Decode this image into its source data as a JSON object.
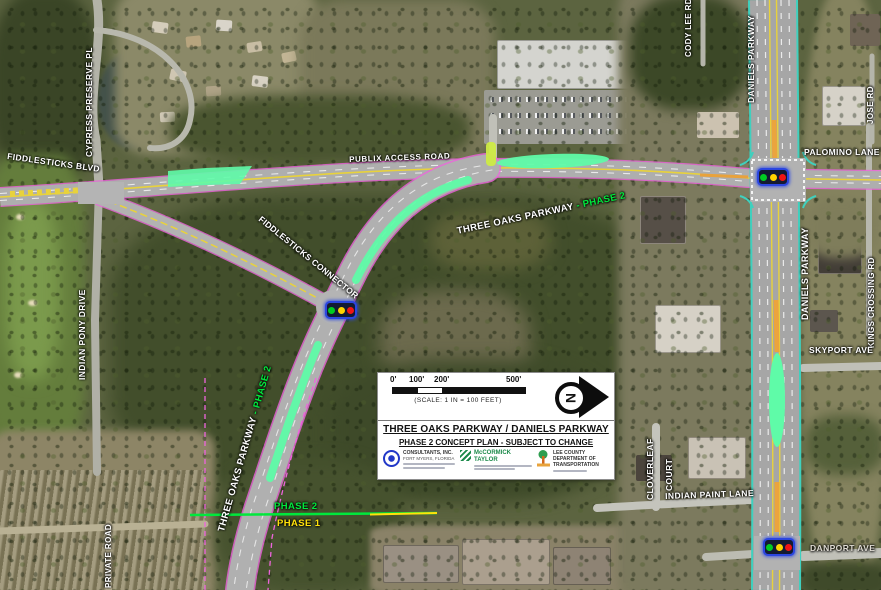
{
  "colors": {
    "phase2_green": "#00e83c",
    "phase1_yellow": "#ffe10a",
    "highlight_green": "#5ffba8",
    "row_magenta": "#ee64dd",
    "lane_yellow": "#e8d23c",
    "edge_teal": "#3fd0be",
    "signal_green": "#00cc22",
    "signal_yellow": "#ffd400",
    "signal_red": "#f01414"
  },
  "map": {
    "labels": [
      {
        "id": "fiddlesticks-blvd",
        "text": "FIDDLESTICKS BLVD"
      },
      {
        "id": "cypress-preserve-pl",
        "text": "CYPRESS PRESERVE PL"
      },
      {
        "id": "publix-access-road",
        "text": "PUBLIX ACCESS ROAD"
      },
      {
        "id": "three-oaks-parkway-curve",
        "text": "THREE OAKS PARKWAY"
      },
      {
        "id": "three-oaks-phase2-curve",
        "text": "- PHASE 2"
      },
      {
        "id": "fiddlesticks-connector",
        "text": "FIDDLESTICKS CONNECTOR"
      },
      {
        "id": "cody-lee-rd",
        "text": "CODY LEE RD"
      },
      {
        "id": "daniels-parkway-north",
        "text": "DANIELS PARKWAY"
      },
      {
        "id": "jose-rd",
        "text": "JOSE RD"
      },
      {
        "id": "palomino-lane",
        "text": "PALOMINO LANE"
      },
      {
        "id": "daniels-parkway-mid",
        "text": "DANIELS PARKWAY"
      },
      {
        "id": "kings-crossing-rd",
        "text": "KINGS CROSSING RD"
      },
      {
        "id": "skyport-ave",
        "text": "SKYPORT AVE"
      },
      {
        "id": "cloverleaf",
        "text": "CLOVERLEAF"
      },
      {
        "id": "court",
        "text": "COURT"
      },
      {
        "id": "indian-paint-lane",
        "text": "INDIAN PAINT LANE"
      },
      {
        "id": "danport-ave",
        "text": "DANPORT AVE"
      },
      {
        "id": "indian-pony-drive",
        "text": "INDIAN PONY DRIVE"
      },
      {
        "id": "private-road",
        "text": "PRIVATE ROAD"
      },
      {
        "id": "three-oaks-parkway-south",
        "text": "THREE OAKS PARKWAY"
      },
      {
        "id": "three-oaks-phase2-south",
        "text": "- PHASE 2"
      },
      {
        "id": "phase-2-marker",
        "text": "PHASE 2"
      },
      {
        "id": "phase-1-marker",
        "text": "PHASE 1"
      }
    ]
  },
  "title_block": {
    "scale_ticks": [
      "0'",
      "100'",
      "200'",
      "500'"
    ],
    "scale_note": "(SCALE: 1 IN = 100 FEET)",
    "title": "THREE OAKS PARKWAY / DANIELS PARKWAY",
    "subtitle": "PHASE 2 CONCEPT PLAN - SUBJECT TO CHANGE",
    "north_label": "N",
    "logos": [
      {
        "line1": "CONSULTANTS, INC.",
        "line2": "FORT MYERS, FLORIDA"
      },
      {
        "line1": "McCORMICK",
        "line2": "TAYLOR"
      },
      {
        "line1": "LEE COUNTY DEPARTMENT OF",
        "line2": "TRANSPORTATION"
      }
    ]
  }
}
